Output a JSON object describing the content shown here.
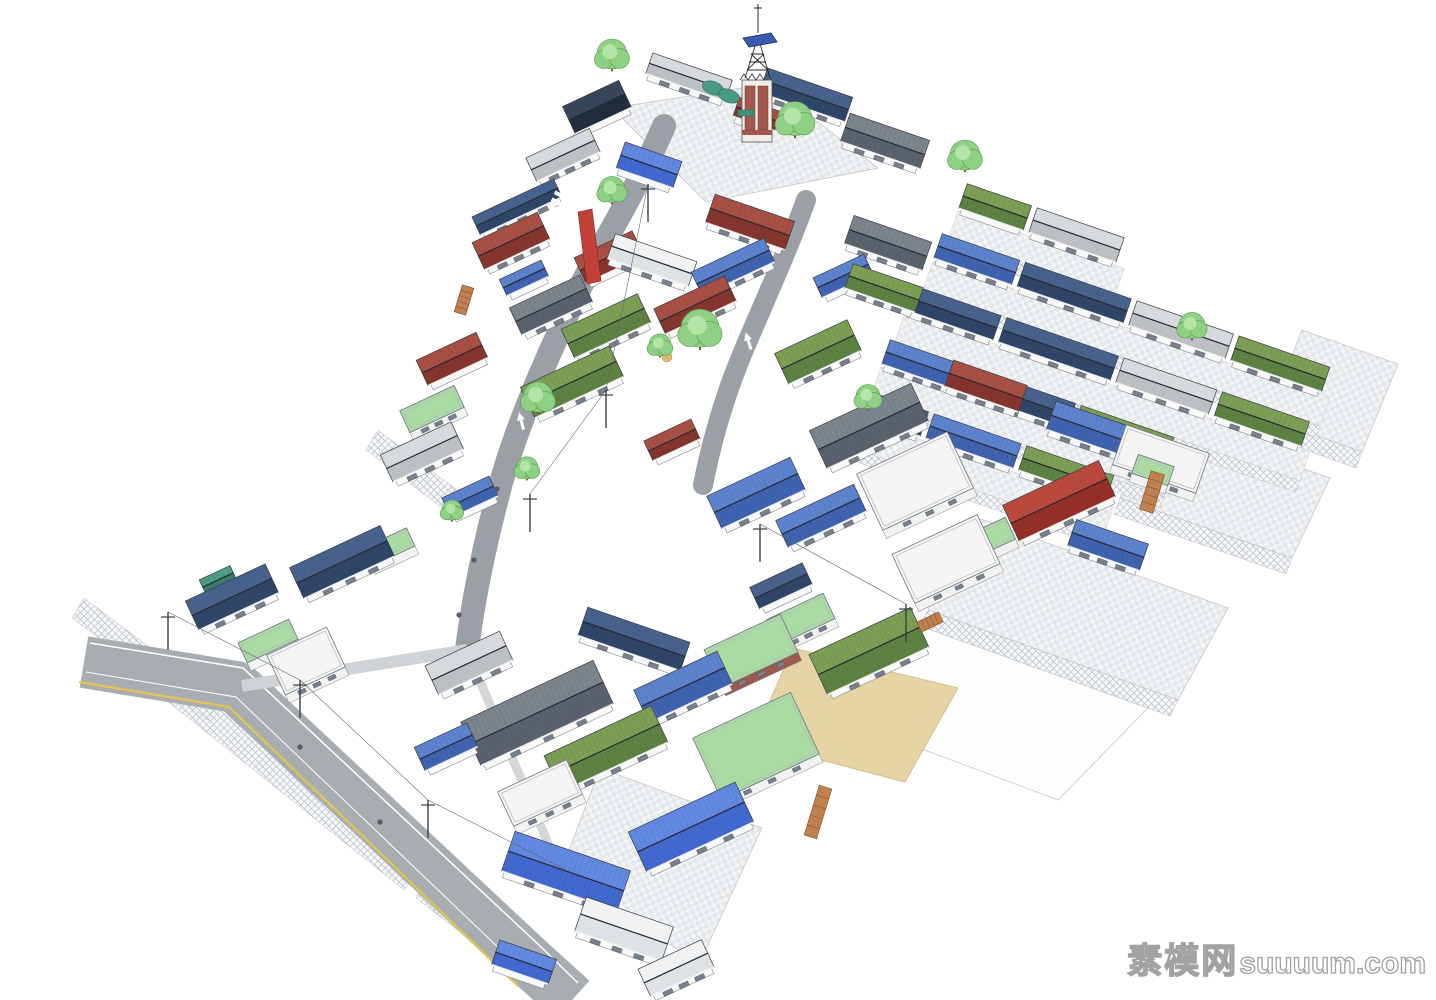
{
  "watermark": {
    "text_cn": "素模网",
    "text_en": "suuuum.com"
  },
  "palette": {
    "wall": "#f8f9f8",
    "wallStroke": "#82878c",
    "edge": "#383d44",
    "roofs": {
      "black": {
        "hi": "#384659",
        "lo": "#212c3c",
        "ribs": true
      },
      "navy": {
        "hi": "#47638d",
        "lo": "#2f4669",
        "ribs": true
      },
      "blue": {
        "hi": "#5d83cf",
        "lo": "#3f63b0",
        "ribs": true
      },
      "bblue": {
        "hi": "#6189e2",
        "lo": "#4169cf",
        "ribs": true
      },
      "red": {
        "hi": "#a94f44",
        "lo": "#86352d",
        "ribs": true
      },
      "bred": {
        "hi": "#bb4a3d",
        "lo": "#962f27",
        "ribs": true
      },
      "green": {
        "hi": "#7d9f55",
        "lo": "#5d8242",
        "ribs": true
      },
      "teal": {
        "hi": "#4f9c87",
        "lo": "#377e6c",
        "ribs": true
      },
      "dkgray": {
        "hi": "#7c848e",
        "lo": "#5a626e",
        "ribs": true
      },
      "ltgray": {
        "hi": "#d7dadd",
        "lo": "#bcc0c5",
        "ribs": false
      },
      "wroof": {
        "hi": "#f1f2f3",
        "lo": "#dfe2e5",
        "ribs": false
      }
    },
    "lawn": "#a9dba3",
    "flatGreen": "#69ab6b",
    "brick": "#9c5a50",
    "sand": "#e6d4a4",
    "road": "#a8adb2",
    "roadNarrow": "#9aa0a5",
    "yellowLine": "#e3c44c",
    "treeFill": "#8fd184",
    "treeLight": "#b4e4a6",
    "treeStroke": "#5d9b52",
    "trunk": "#7a5a3a",
    "stair": "#c08050",
    "towerBrick": "#a3584e",
    "platformBlue": "#3b5cae",
    "bannerRed": "#c14038"
  },
  "scene": {
    "plates": [
      {
        "k": "pave",
        "pts": [
          [
            612,
            108
          ],
          [
            768,
            84
          ],
          [
            878,
            168
          ],
          [
            706,
            202
          ]
        ]
      },
      {
        "k": "pave",
        "pts": [
          [
            1302,
            330
          ],
          [
            1398,
            364
          ],
          [
            1362,
            452
          ],
          [
            1268,
            418
          ]
        ]
      },
      {
        "k": "pave",
        "pts": [
          [
            1158,
            418
          ],
          [
            1330,
            478
          ],
          [
            1292,
            558
          ],
          [
            1120,
            498
          ]
        ]
      },
      {
        "k": "pave",
        "pts": [
          [
            978,
            518
          ],
          [
            1228,
            608
          ],
          [
            1178,
            700
          ],
          [
            928,
            610
          ]
        ]
      },
      {
        "k": "white",
        "pts": [
          [
            898,
            618
          ],
          [
            1148,
            708
          ],
          [
            1058,
            800
          ],
          [
            818,
            710
          ]
        ]
      },
      {
        "k": "pave",
        "pts": [
          [
            600,
            768
          ],
          [
            762,
            828
          ],
          [
            700,
            962
          ],
          [
            558,
            880
          ]
        ]
      }
    ],
    "sand": [
      [
        793,
        648
      ],
      [
        958,
        688
      ],
      [
        905,
        782
      ],
      [
        752,
        742
      ]
    ],
    "hatches": [
      [
        [
          150,
          655
        ],
        [
          420,
          868
        ],
        [
          404,
          890
        ],
        [
          136,
          676
        ]
      ],
      [
        [
          424,
          878
        ],
        [
          560,
          985
        ],
        [
          548,
          1000
        ],
        [
          416,
          898
        ]
      ],
      [
        [
          1268,
          418
        ],
        [
          1362,
          452
        ],
        [
          1356,
          468
        ],
        [
          1262,
          434
        ]
      ],
      [
        [
          1120,
          498
        ],
        [
          1292,
          558
        ],
        [
          1286,
          574
        ],
        [
          1114,
          514
        ]
      ],
      [
        [
          928,
          610
        ],
        [
          1178,
          700
        ],
        [
          1170,
          716
        ],
        [
          920,
          626
        ]
      ],
      [
        [
          378,
          430
        ],
        [
          470,
          500
        ],
        [
          458,
          520
        ],
        [
          366,
          450
        ]
      ],
      [
        [
          84,
          598
        ],
        [
          220,
          700
        ],
        [
          208,
          720
        ],
        [
          72,
          618
        ]
      ]
    ],
    "roads": {
      "main": {
        "d": "M84,662 L236,687 L530,962 L572,1000",
        "w": 52
      },
      "lines": [
        {
          "d": "M90,643 L243,668 L540,946 L578,983",
          "w": 1.5,
          "c": "#ffffff"
        },
        {
          "d": "M79,682 L229,707 L518,986",
          "w": 2.2,
          "c": "#e3c44c"
        },
        {
          "d": "M86,672 L236,697 L526,974",
          "w": 1,
          "c": "#ffffff"
        }
      ],
      "internal": {
        "d": "M664,126 C628,208 596,252 572,304 C544,364 514,432 498,494 C486,540 474,592 467,650",
        "w": 24
      },
      "internal2": {
        "d": "M806,200 C788,250 765,300 743,352 C724,397 712,440 703,485",
        "w": 20
      },
      "alley": {
        "d": "M467,650 L242,686",
        "w": 12,
        "c": "#cfd3d6"
      },
      "side": {
        "d": "M467,650 L560,872",
        "w": 9,
        "c": "#d5d8da"
      }
    },
    "rows": [
      {
        "x": 963,
        "y": 196,
        "segs": [
          [
            "green",
            68
          ],
          [
            "ltgray",
            92
          ]
        ]
      },
      {
        "x": 938,
        "y": 246,
        "segs": [
          [
            "blue",
            82
          ],
          [
            "navy",
            112
          ],
          [
            "ltgray",
            102
          ],
          [
            "green",
            96
          ]
        ]
      },
      {
        "x": 910,
        "y": 298,
        "segs": [
          [
            "navy",
            92
          ],
          [
            "navy",
            118
          ],
          [
            "ltgray",
            98
          ],
          [
            "green",
            92
          ]
        ]
      },
      {
        "x": 886,
        "y": 352,
        "segs": [
          [
            "blue",
            78
          ],
          [
            "navy",
            112
          ],
          [
            "green",
            98
          ]
        ]
      },
      {
        "x": 860,
        "y": 402,
        "segs": [
          [
            "navy",
            68
          ],
          [
            "blue",
            92
          ],
          [
            "green",
            92
          ]
        ]
      }
    ],
    "houses": [
      [
        "black",
        597,
        107,
        62,
        30,
        -25
      ],
      [
        "ltgray",
        689,
        77,
        84,
        22,
        19
      ],
      [
        "navy",
        806,
        95,
        90,
        26,
        19
      ],
      [
        "dkgray",
        885,
        141,
        84,
        30,
        19
      ],
      [
        "bblue",
        649,
        165,
        60,
        28,
        19
      ],
      [
        "ltgray",
        563,
        155,
        70,
        26,
        -25
      ],
      [
        "navy",
        517,
        207,
        90,
        20,
        -25
      ],
      [
        "red",
        609,
        257,
        64,
        28,
        -25
      ],
      [
        "wroof",
        652,
        260,
        86,
        26,
        19
      ],
      [
        "blue",
        733,
        267,
        80,
        26,
        -25
      ],
      [
        "blue",
        843,
        276,
        56,
        22,
        -25
      ],
      [
        "red",
        695,
        305,
        78,
        28,
        -25
      ],
      [
        "red",
        750,
        222,
        84,
        30,
        19
      ],
      [
        "dkgray",
        888,
        243,
        82,
        30,
        19
      ],
      [
        "green",
        884,
        288,
        74,
        26,
        19
      ],
      [
        "red",
        757,
        114,
        44,
        20,
        19
      ],
      [
        "red",
        511,
        241,
        72,
        30,
        -25
      ],
      [
        "blue",
        524,
        278,
        46,
        18,
        -25
      ],
      [
        "dkgray",
        551,
        305,
        78,
        30,
        -25
      ],
      [
        "red",
        452,
        359,
        66,
        28,
        -25
      ],
      [
        "ltgray",
        422,
        452,
        78,
        30,
        -25
      ],
      [
        "blue",
        470,
        497,
        52,
        22,
        -25
      ],
      [
        "navy",
        342,
        562,
        100,
        34,
        -25
      ],
      [
        "navy",
        232,
        597,
        88,
        32,
        -25
      ],
      [
        "teal",
        218,
        580,
        34,
        16,
        -25
      ],
      [
        "green",
        606,
        326,
        84,
        32,
        -25
      ],
      [
        "green",
        572,
        382,
        98,
        34,
        -25
      ],
      [
        "green",
        818,
        352,
        80,
        34,
        -25
      ],
      [
        "dkgray",
        869,
        426,
        112,
        42,
        -25
      ],
      [
        "blue",
        756,
        493,
        92,
        36,
        -25
      ],
      [
        "blue",
        821,
        516,
        86,
        30,
        -25
      ],
      [
        "red",
        986,
        386,
        78,
        28,
        19
      ],
      [
        "bred",
        1059,
        501,
        106,
        40,
        -25
      ],
      [
        "blue",
        1091,
        429,
        84,
        30,
        19
      ],
      [
        "blue",
        1108,
        545,
        76,
        28,
        19
      ],
      [
        "navy",
        781,
        586,
        58,
        24,
        -25
      ],
      [
        "red",
        672,
        440,
        52,
        22,
        -25
      ],
      [
        "ltgray",
        469,
        663,
        82,
        32,
        -25
      ],
      [
        "dkgray",
        537,
        713,
        146,
        48,
        -25
      ],
      [
        "navy",
        634,
        639,
        108,
        30,
        19
      ],
      [
        "blue",
        683,
        687,
        92,
        36,
        -25
      ],
      [
        "green",
        606,
        749,
        118,
        40,
        -25
      ],
      [
        "blue",
        446,
        747,
        58,
        26,
        -25
      ],
      [
        "green",
        869,
        651,
        112,
        44,
        -25
      ],
      [
        "bblue",
        691,
        827,
        118,
        44,
        -25
      ],
      [
        "bblue",
        566,
        871,
        122,
        42,
        19
      ],
      [
        "wroof",
        624,
        929,
        92,
        36,
        19
      ],
      [
        "wroof",
        676,
        968,
        70,
        30,
        -25
      ],
      [
        "bblue",
        524,
        962,
        60,
        26,
        19
      ]
    ],
    "flats": [
      [
        "white",
        915,
        481,
        100,
        62,
        -25
      ],
      [
        "white",
        946,
        559,
        94,
        54,
        -25
      ],
      [
        "white",
        306,
        661,
        66,
        44,
        -25
      ],
      [
        "lawn",
        756,
        746,
        108,
        68,
        -25
      ],
      [
        "brick",
        751,
        651,
        84,
        42,
        -25
      ],
      [
        "lawn",
        801,
        619,
        62,
        28,
        -25
      ],
      [
        "white",
        1161,
        459,
        88,
        42,
        19
      ],
      [
        "lawn",
        1153,
        470,
        38,
        20,
        19
      ],
      [
        "lawn",
        985,
        540,
        56,
        24,
        -25
      ],
      [
        "white",
        540,
        793,
        76,
        38,
        -25
      ],
      [
        "lawn",
        432,
        409,
        60,
        24,
        -25
      ],
      [
        "lawn",
        268,
        641,
        56,
        22,
        -25
      ],
      [
        "lawn",
        389,
        547,
        48,
        20,
        -25
      ]
    ],
    "trees": [
      [
        612,
        57,
        15
      ],
      [
        795,
        122,
        17
      ],
      [
        965,
        158,
        15
      ],
      [
        700,
        332,
        19
      ],
      [
        612,
        192,
        13
      ],
      [
        538,
        400,
        15
      ],
      [
        660,
        347,
        11
      ],
      [
        1192,
        328,
        13
      ],
      [
        868,
        399,
        12
      ],
      [
        527,
        470,
        11
      ],
      [
        452,
        512,
        10
      ]
    ],
    "poles": [
      [
        168,
        650
      ],
      [
        300,
        718
      ],
      [
        428,
        838
      ],
      [
        530,
        532
      ],
      [
        606,
        428
      ],
      [
        648,
        222
      ],
      [
        760,
        562
      ],
      [
        906,
        642
      ]
    ],
    "wires": [
      [
        [
          168,
          612
        ],
        [
          300,
          680
        ],
        [
          428,
          800
        ],
        [
          566,
          870
        ]
      ],
      [
        [
          530,
          494
        ],
        [
          606,
          390
        ],
        [
          648,
          184
        ]
      ],
      [
        [
          760,
          524
        ],
        [
          906,
          604
        ]
      ]
    ],
    "extras": {
      "stairs": [
        {
          "x": 930,
          "y": 622,
          "w": 24,
          "h": 11,
          "a": -25
        },
        {
          "x": 818,
          "y": 812,
          "w": 13,
          "h": 52,
          "a": 17
        },
        {
          "x": 1152,
          "y": 492,
          "w": 14,
          "h": 40,
          "a": 17
        },
        {
          "x": 464,
          "y": 300,
          "w": 12,
          "h": 28,
          "a": 17
        }
      ],
      "quonsets": [
        [
          713,
          88
        ],
        [
          729,
          96
        ]
      ],
      "banner": [
        [
          578,
          212
        ],
        [
          592,
          209
        ],
        [
          601,
          281
        ],
        [
          587,
          284
        ]
      ],
      "crosswalk": [
        [
          551,
          216
        ],
        [
          554,
          209
        ],
        [
          557,
          202
        ],
        [
          560,
          195
        ]
      ],
      "arrows": [
        {
          "x": 521,
          "y": 420,
          "a": -15
        },
        {
          "x": 748,
          "y": 340,
          "a": -18
        }
      ],
      "manholes": [
        [
          497,
          489
        ],
        [
          474,
          560
        ],
        [
          459,
          615
        ],
        [
          300,
          747
        ],
        [
          380,
          822
        ]
      ],
      "dots": [
        {
          "x": 667,
          "y": 357,
          "r": 5,
          "c": "#dcb868"
        }
      ]
    },
    "tower": {
      "x": 757,
      "y": 80
    }
  }
}
